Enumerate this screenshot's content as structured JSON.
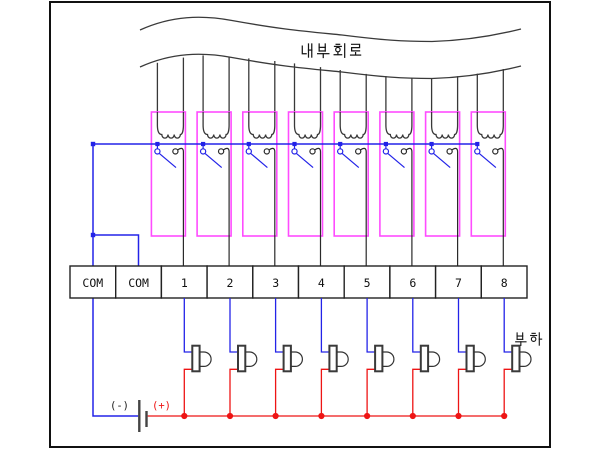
{
  "diagram": {
    "internal_circuit_label": "내부회로",
    "load_label": "부하",
    "battery": {
      "negative_label": "(-)",
      "positive_label": "(+)"
    },
    "terminals": {
      "labels": [
        "COM",
        "COM",
        "1",
        "2",
        "3",
        "4",
        "5",
        "6",
        "7",
        "8"
      ]
    },
    "relay_count": 8,
    "load_count": 8,
    "colors": {
      "common_wire_blue": "#2323e8",
      "load_wire_red": "#ee1414",
      "relay_outline_magenta": "#ff4cff",
      "circuit_line_gray": "#383838"
    }
  }
}
